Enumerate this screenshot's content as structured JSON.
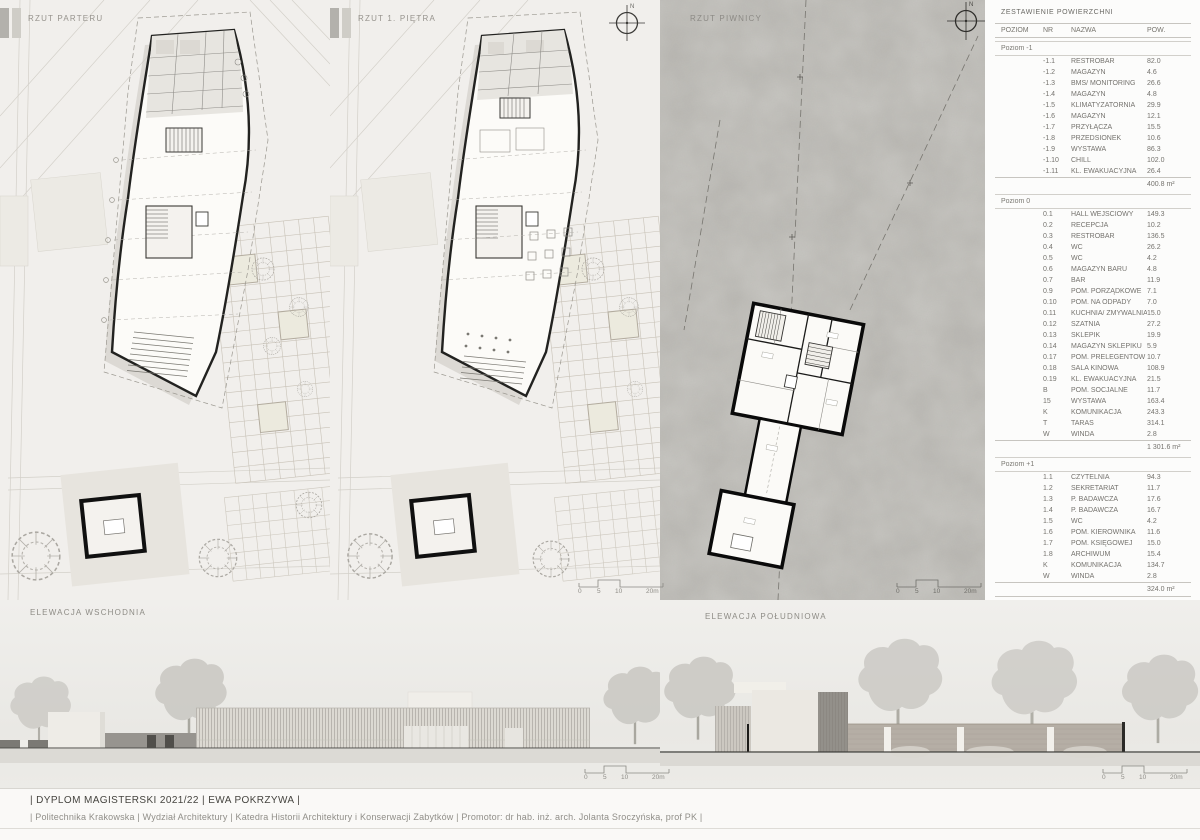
{
  "board": {
    "plans": [
      {
        "title": "RZUT PARTERU"
      },
      {
        "title": "RZUT 1. PIĘTRA"
      },
      {
        "title": "RZUT PIWNICY"
      }
    ],
    "elevations": [
      {
        "title": "ELEWACJA WSCHODNIA"
      },
      {
        "title": "ELEWACJA POŁUDNIOWA"
      }
    ]
  },
  "compass": {
    "label": "N"
  },
  "scalebar": {
    "labels": [
      "0",
      "5",
      "10",
      "20m"
    ]
  },
  "table": {
    "title": "ZESTAWIENIE POWIERZCHNI",
    "columns": [
      "POZIOM",
      "NR",
      "NAZWA",
      "POW."
    ],
    "sections": [
      {
        "label": "Poziom -1",
        "rows": [
          [
            "-1.1",
            "RESTROBAR",
            "82.0"
          ],
          [
            "-1.2",
            "MAGAZYN",
            "4.6"
          ],
          [
            "-1.3",
            "BMS/ MONITORING",
            "26.6"
          ],
          [
            "-1.4",
            "MAGAZYN",
            "4.8"
          ],
          [
            "-1.5",
            "KLIMATYZATORNIA",
            "29.9"
          ],
          [
            "-1.6",
            "MAGAZYN",
            "12.1"
          ],
          [
            "-1.7",
            "PRZYŁĄCZA",
            "15.5"
          ],
          [
            "-1.8",
            "PRZEDSIONEK",
            "10.6"
          ],
          [
            "-1.9",
            "WYSTAWA",
            "86.3"
          ],
          [
            "-1.10",
            "CHILL",
            "102.0"
          ],
          [
            "-1.11",
            "KL. EWAKUACYJNA",
            "26.4"
          ]
        ],
        "subtotal": "400.8 m²"
      },
      {
        "label": "Poziom 0",
        "rows": [
          [
            "0.1",
            "HALL WEJŚCIOWY",
            "149.3"
          ],
          [
            "0.2",
            "RECEPCJA",
            "10.2"
          ],
          [
            "0.3",
            "RESTROBAR",
            "136.5"
          ],
          [
            "0.4",
            "WC",
            "26.2"
          ],
          [
            "0.5",
            "WC",
            "4.2"
          ],
          [
            "0.6",
            "MAGAZYN BARU",
            "4.8"
          ],
          [
            "0.7",
            "BAR",
            "11.9"
          ],
          [
            "0.9",
            "POM. PORZĄDKOWE",
            "7.1"
          ],
          [
            "0.10",
            "POM. NA ODPADY",
            "7.0"
          ],
          [
            "0.11",
            "KUCHNIA/ ZMYWALNIA",
            "15.0"
          ],
          [
            "0.12",
            "SZATNIA",
            "27.2"
          ],
          [
            "0.13",
            "SKLEPIK",
            "19.9"
          ],
          [
            "0.14",
            "MAGAZYN SKLEPIKU",
            "5.9"
          ],
          [
            "0.17",
            "POM. PRELEGENTÓW",
            "10.7"
          ],
          [
            "0.18",
            "SALA KINOWA",
            "108.9"
          ],
          [
            "0.19",
            "KL. EWAKUACYJNA",
            "21.5"
          ],
          [
            "B",
            "POM. SOCJALNE",
            "11.7"
          ],
          [
            "15",
            "WYSTAWA",
            "163.4"
          ],
          [
            "K",
            "KOMUNIKACJA",
            "243.3"
          ],
          [
            "T",
            "TARAS",
            "314.1"
          ],
          [
            "W",
            "WINDA",
            "2.8"
          ]
        ],
        "subtotal": "1 301.6 m²"
      },
      {
        "label": "Poziom +1",
        "rows": [
          [
            "1.1",
            "CZYTELNIA",
            "94.3"
          ],
          [
            "1.2",
            "SEKRETARIAT",
            "11.7"
          ],
          [
            "1.3",
            "P. BADAWCZA",
            "17.6"
          ],
          [
            "1.4",
            "P. BADAWCZA",
            "16.7"
          ],
          [
            "1.5",
            "WC",
            "4.2"
          ],
          [
            "1.6",
            "POM. KIEROWNIKA",
            "11.6"
          ],
          [
            "1.7",
            "POM. KSIĘGOWEJ",
            "15.0"
          ],
          [
            "1.8",
            "ARCHIWUM",
            "15.4"
          ],
          [
            "K",
            "KOMUNIKACJA",
            "134.7"
          ],
          [
            "W",
            "WINDA",
            "2.8"
          ]
        ],
        "subtotal": "324.0 m²"
      }
    ],
    "total": "2 026.4 m²"
  },
  "titleblock": {
    "line1": "| DYPLOM MAGISTERSKI 2021/22 | EWA POKRZYWA |",
    "line2": "| Politechnika Krakowska | Wydział Architektury | Katedra Historii Architektury i Konserwacji Zabytków | Promotor: dr hab. inż. arch. Jolanta Sroczyńska, prof PK |"
  },
  "colors": {
    "ink": "#1c1c1c",
    "muted_text": "#8f8d88",
    "concrete": "#b8b6b1",
    "paper": "#f2f1ee"
  }
}
